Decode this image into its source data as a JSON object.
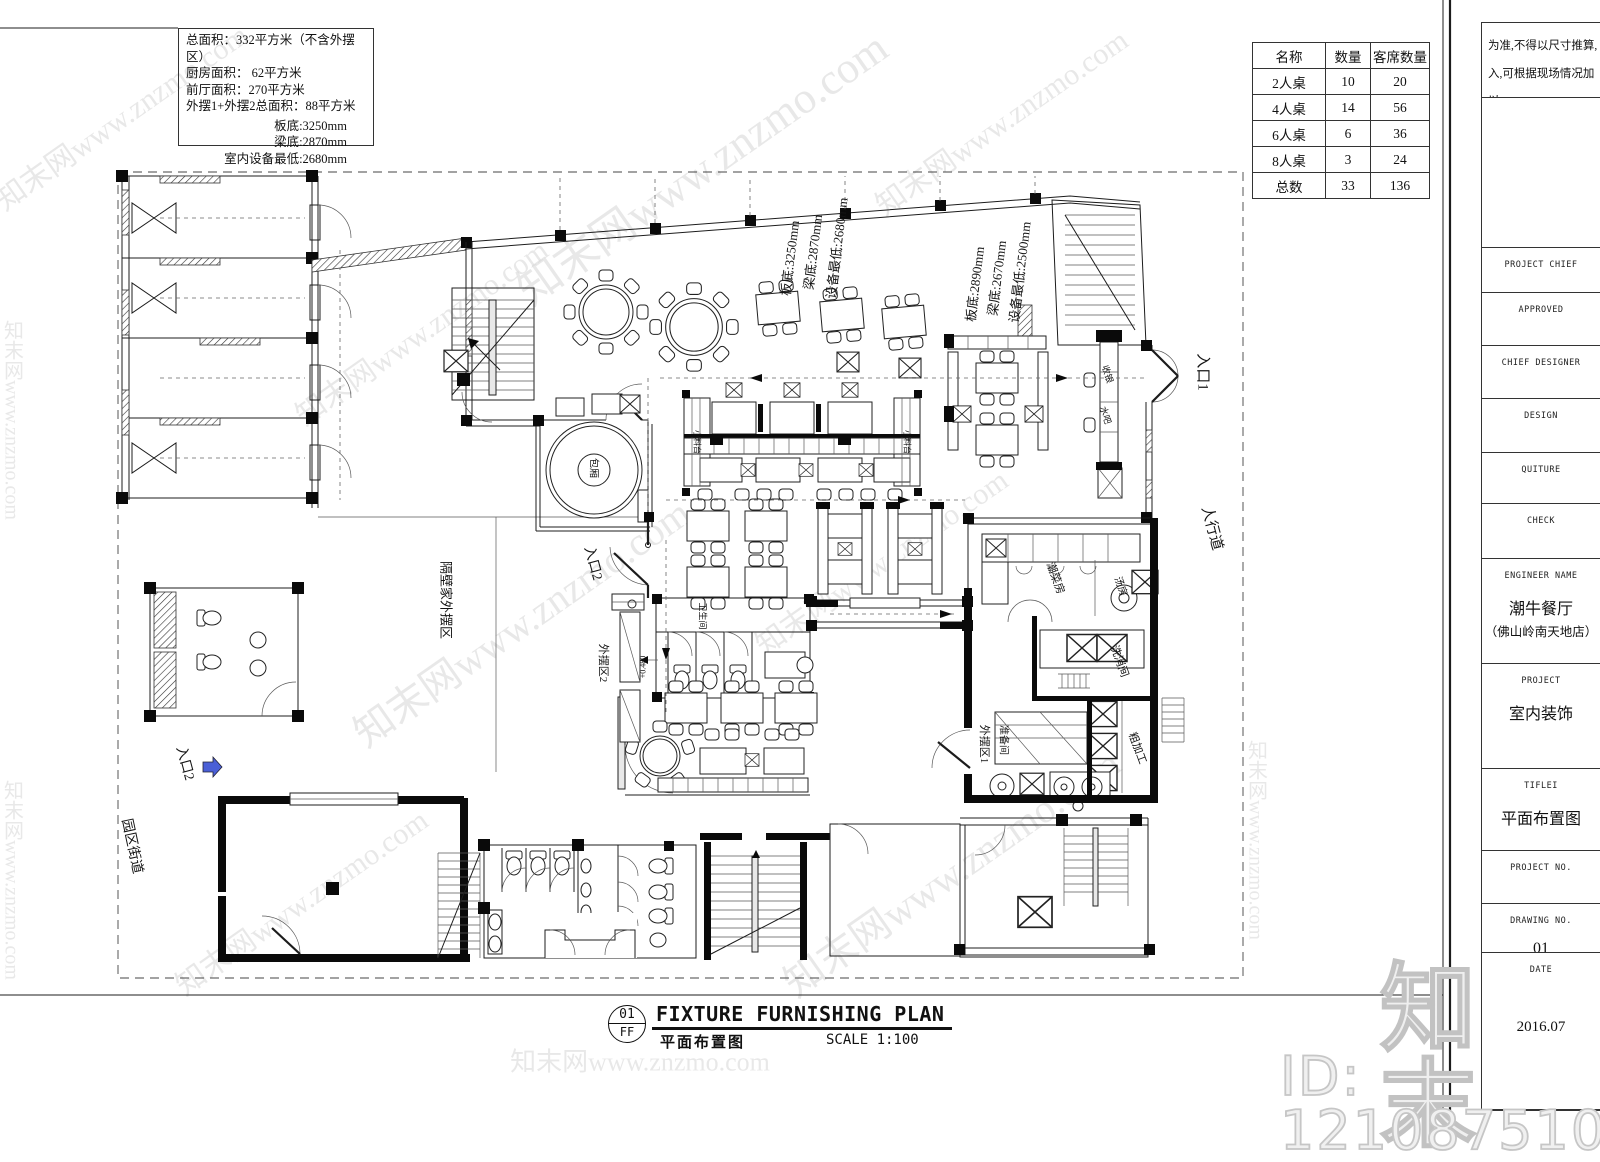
{
  "info_block": {
    "lines": [
      "总面积：332平方米（不含外摆区）",
      "厨房面积： 62平方米",
      "前厅面积：270平方米",
      "外摆1+外摆2总面积：88平方米"
    ],
    "levels": [
      "板底:3250mm",
      "梁底:2870mm",
      "室内设备最低:2680mm"
    ]
  },
  "seat_table": {
    "headers": [
      "名称",
      "数量",
      "客席数量"
    ],
    "rows": [
      [
        "2人桌",
        "10",
        "20"
      ],
      [
        "4人桌",
        "14",
        "56"
      ],
      [
        "6人桌",
        "6",
        "36"
      ],
      [
        "8人桌",
        "3",
        "24"
      ],
      [
        "总数",
        "33",
        "136"
      ]
    ]
  },
  "title_block": {
    "notes": [
      "为准,不得以尺寸推算,",
      "入,可根据现场情况加以"
    ],
    "fields": [
      {
        "label": "PROJECT CHIEF"
      },
      {
        "label": "APPROVED"
      },
      {
        "label": "CHIEF DESIGNER"
      },
      {
        "label": "DESIGN"
      },
      {
        "label": "QUITURE"
      },
      {
        "label": "CHECK"
      },
      {
        "label": "ENGINEER NAME",
        "value": "潮牛餐厅",
        "value2": "（佛山岭南天地店）"
      },
      {
        "label": "PROJECT",
        "value": "室内装饰"
      },
      {
        "label": "TIFLEI",
        "value": "平面布置图"
      },
      {
        "label": "PROJECT NO."
      },
      {
        "label": "DRAWING NO.",
        "value": "01"
      },
      {
        "label": "DATE",
        "value": "2016.07"
      }
    ]
  },
  "sheet_title": {
    "number": "01",
    "code": "FF",
    "title_en": "FIXTURE FURNISHING PLAN",
    "title_cn": "平面布置图",
    "scale": "SCALE 1:100"
  },
  "watermark": {
    "logo": "知末",
    "id_text": "ID: 1210875102",
    "tile": "知末网www.znzmo.com"
  },
  "plan": {
    "labels": [
      {
        "t": "入口1",
        "x": 1204,
        "y": 372,
        "r": 90,
        "s": 15
      },
      {
        "t": "人行道",
        "x": 1213,
        "y": 528,
        "r": 75,
        "s": 15
      },
      {
        "t": "入口2",
        "x": 594,
        "y": 563,
        "r": 75,
        "s": 14
      },
      {
        "t": "入口2",
        "x": 186,
        "y": 763,
        "r": 75,
        "s": 14
      },
      {
        "t": "园区街道",
        "x": 133,
        "y": 846,
        "r": 78,
        "s": 14
      },
      {
        "t": "隔壁家外摆区",
        "x": 447,
        "y": 600,
        "r": 90,
        "s": 13
      },
      {
        "t": "外摆区2",
        "x": 604,
        "y": 663,
        "r": 90,
        "s": 11
      },
      {
        "t": "外摆区1",
        "x": 985,
        "y": 744,
        "r": 90,
        "s": 11
      },
      {
        "t": "包厢",
        "x": 595,
        "y": 468,
        "r": 90,
        "s": 10
      },
      {
        "t": "卫生间",
        "x": 703,
        "y": 616,
        "r": 90,
        "s": 9
      },
      {
        "t": "收银",
        "x": 1108,
        "y": 374,
        "r": 72,
        "s": 9
      },
      {
        "t": "水吧",
        "x": 1106,
        "y": 415,
        "r": 72,
        "s": 9
      },
      {
        "t": "小料台",
        "x": 697,
        "y": 442,
        "r": 90,
        "s": 8
      },
      {
        "t": "小料台",
        "x": 907,
        "y": 442,
        "r": 90,
        "s": 8
      },
      {
        "t": "潮菜房",
        "x": 1056,
        "y": 578,
        "r": 70,
        "s": 11
      },
      {
        "t": "汤房",
        "x": 1122,
        "y": 586,
        "r": 70,
        "s": 10
      },
      {
        "t": "洗消间",
        "x": 1120,
        "y": 661,
        "r": 70,
        "s": 11
      },
      {
        "t": "准备间",
        "x": 1005,
        "y": 740,
        "r": 90,
        "s": 10
      },
      {
        "t": "粗加工",
        "x": 1138,
        "y": 748,
        "r": 70,
        "s": 11
      },
      {
        "t": "+0.480",
        "x": 643,
        "y": 667,
        "r": -90,
        "s": 8
      },
      {
        "t": "板底:3250mm",
        "x": 789,
        "y": 258,
        "r": -83,
        "s": 13
      },
      {
        "t": "梁底:2870mm",
        "x": 812,
        "y": 252,
        "r": -83,
        "s": 13
      },
      {
        "t": "设备最低:2680mm",
        "x": 836,
        "y": 248,
        "r": -83,
        "s": 13
      },
      {
        "t": "板底:2890mm",
        "x": 974,
        "y": 284,
        "r": -83,
        "s": 13
      },
      {
        "t": "梁底:2670mm",
        "x": 996,
        "y": 278,
        "r": -83,
        "s": 13
      },
      {
        "t": "设备最低:2500mm",
        "x": 1019,
        "y": 272,
        "r": -83,
        "s": 13
      }
    ]
  }
}
